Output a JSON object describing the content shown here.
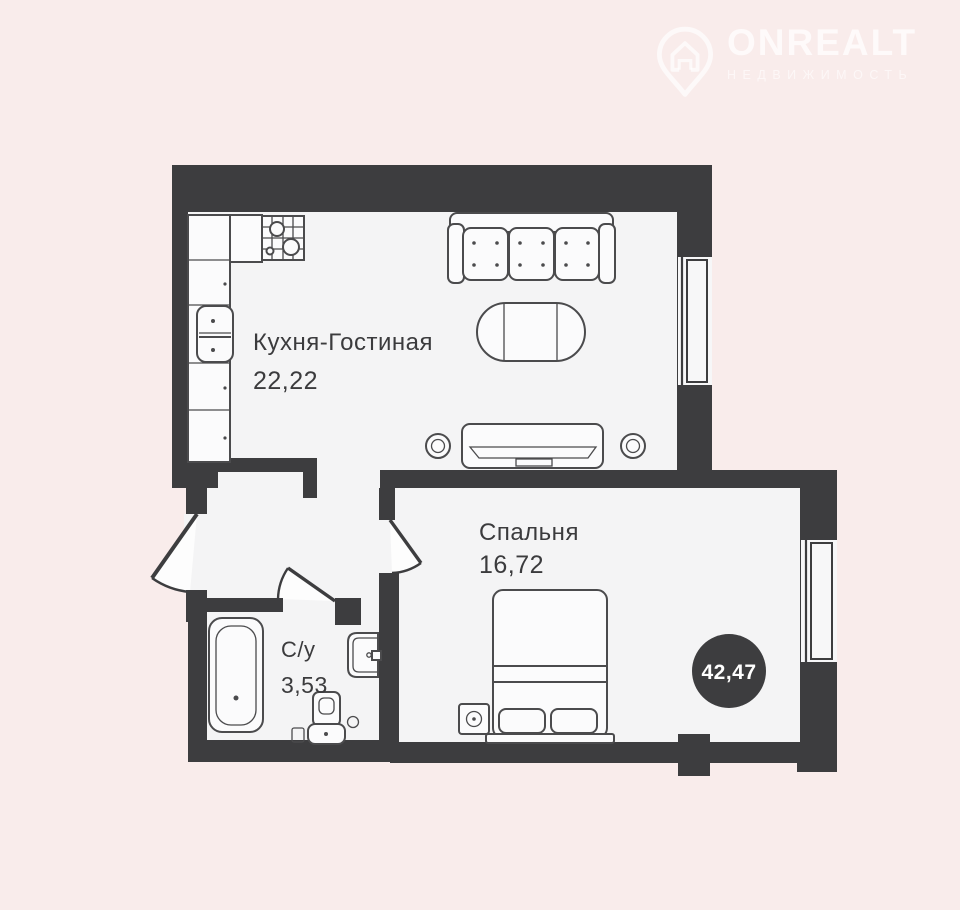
{
  "page": {
    "background_color": "#f9eceb"
  },
  "watermark_logo": {
    "brand": "ONREALT",
    "tagline": "НЕДВИЖИМОСТЬ",
    "icon": "house-pin-icon",
    "color": "#ffffff"
  },
  "floor_plan": {
    "wall_color": "#3d3d3f",
    "floor_color": "#f4f4f5",
    "rooms": [
      {
        "name": "Кухня-Гостиная",
        "area": "22,22"
      },
      {
        "name": "Спальня",
        "area": "16,72"
      },
      {
        "name": "С/у",
        "area": "3,53"
      }
    ],
    "total_area_badge": {
      "value": "42,47",
      "background": "#3d3d3f",
      "text_color": "#ffffff"
    },
    "fixtures": [
      "kitchen-counter",
      "stove-icon",
      "kitchen-sink-icon",
      "sofa",
      "coffee-table",
      "tv-stand",
      "speaker-icon",
      "bed",
      "nightstand-lamp",
      "bathtub-icon",
      "washbasin-icon",
      "toilet-icon"
    ],
    "windows_count": 2,
    "doors_count": 3
  }
}
